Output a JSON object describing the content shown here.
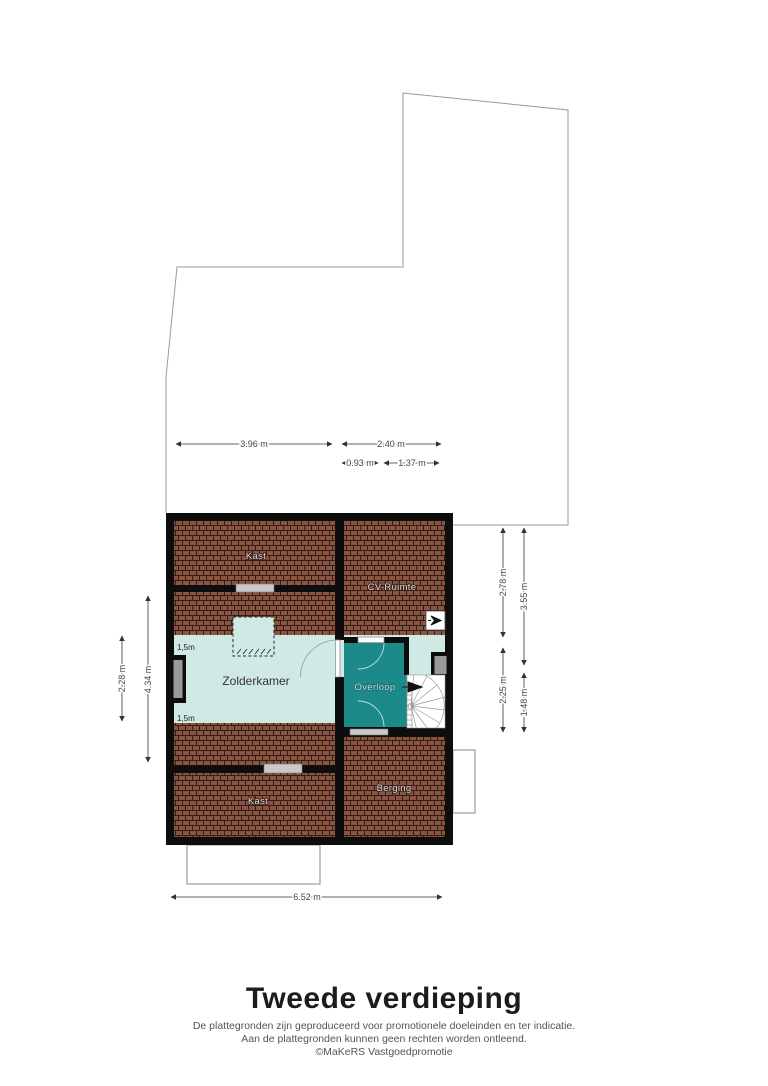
{
  "plan": {
    "rooms": {
      "kast_top": "Kast",
      "cv_ruimte": "CV-Ruimte",
      "zolderkamer": "Zolderkamer",
      "overloop": "Overloop",
      "berging": "Berging",
      "kast_bottom": "Kast"
    },
    "clearance": {
      "top": "1,5m",
      "bottom": "1,5m"
    },
    "dimensions": {
      "top_width_left": "3.96 m",
      "top_width_right": "2.40 m",
      "top_sub_left": "0.93 m",
      "top_sub_right": "1.37 m",
      "right_inner_top": "2.78 m",
      "right_inner_bottom": "2.25 m",
      "right_outer_top": "3.55 m",
      "right_outer_bottom": "1.48 m",
      "left_inner": "2.28 m",
      "left_outer": "4.34 m",
      "bottom_width": "6.52 m"
    },
    "icons": {
      "ventilation": "mechanical-ventilation-icon",
      "stair_direction": "stair-up-arrow-icon"
    }
  },
  "footer": {
    "title": "Tweede verdieping",
    "disclaimer_line1": "De plattegronden zijn geproduceerd voor promotionele doeleinden en ter indicatie.",
    "disclaimer_line2": "Aan de plattegronden kunnen geen rechten worden ontleend.",
    "credit": "©MaKeRS Vastgoedpromotie"
  },
  "colors": {
    "roof_tile": "#8a5443",
    "tile_mortar": "#331d15",
    "wall": "#0d0d0d",
    "room_light": "#cfe9e5",
    "landing_teal": "#1d8a8a",
    "outline_gray": "#9a9a9a",
    "window_gray": "#9a9a9a",
    "slab_gray": "#c9c9c9"
  }
}
